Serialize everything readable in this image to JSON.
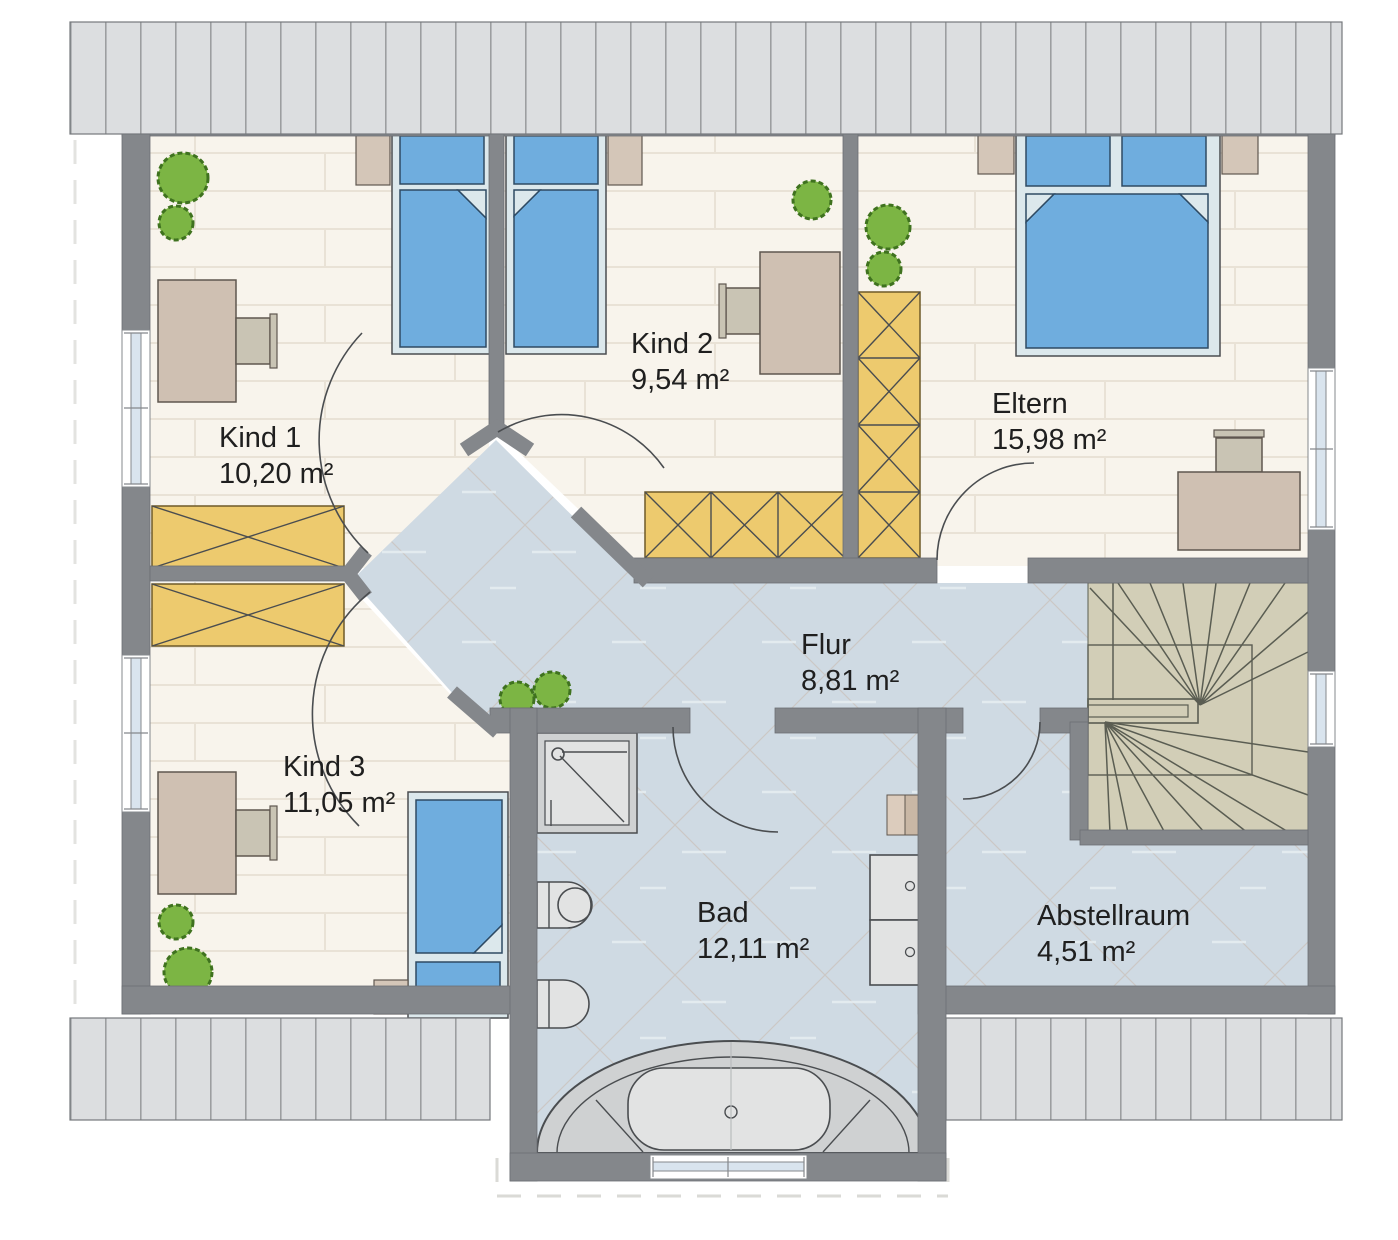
{
  "rooms": {
    "kind1": {
      "name": "Kind 1",
      "area": "10,20 m²"
    },
    "kind2": {
      "name": "Kind 2",
      "area": "9,54 m²"
    },
    "eltern": {
      "name": "Eltern",
      "area": "15,98 m²"
    },
    "flur": {
      "name": "Flur",
      "area": "8,81 m²"
    },
    "kind3": {
      "name": "Kind 3",
      "area": "11,05 m²"
    },
    "bad": {
      "name": "Bad",
      "area": "12,11 m²"
    },
    "abstellraum": {
      "name": "Abstellraum",
      "area": "4,51 m²"
    }
  },
  "colors": {
    "wall": "#84878b",
    "wall-edge": "#6c6f73",
    "outline": "#4a4d50",
    "floor-wood": "#f8f4ec",
    "plank-line": "#e9e2d6",
    "floor-tile": "#cfdae3",
    "tile-line": "#c9beb5",
    "tile-streak": "#e9eff3",
    "stairs": "#d2ceb7",
    "stair-line": "#5a5d52",
    "bed-frame": "#dce8ec",
    "bed-blue": "#6fadde",
    "bed-edge": "#2e4a63",
    "furn-beige": "#cfc0b2",
    "furn-edge": "#5f574f",
    "chair": "#c9c4b4",
    "nightstand": "#d4c6b8",
    "wardrobe": "#edca6e",
    "wardrobe-edge": "#6e5a28",
    "plant": "#7cb544",
    "plant-edge": "#3f721f",
    "fixture": "#e2e3e3",
    "fixture-dim": "#cfd1d2",
    "roof": "#dcdee0",
    "roof-line": "#989a9d",
    "window-blue": "#d9e4ee",
    "dash": "#e3e3e0"
  }
}
